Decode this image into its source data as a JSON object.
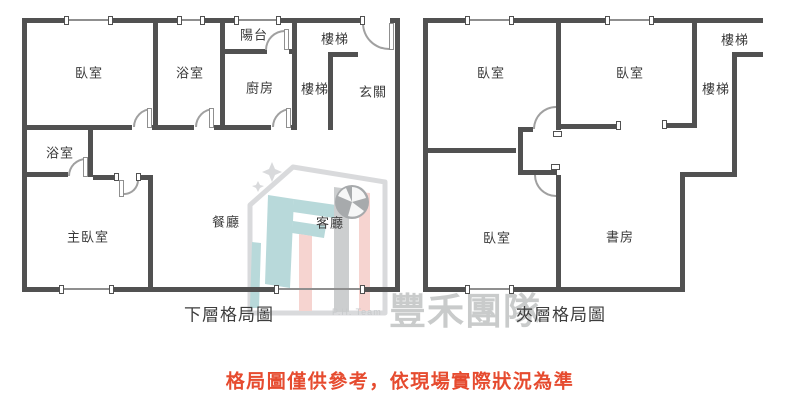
{
  "plans": {
    "lower": {
      "caption": "下層格局圖",
      "rooms": {
        "bedroom": "臥室",
        "bath1": "浴室",
        "balcony": "陽台",
        "kitchen": "廚房",
        "stairs1": "樓梯",
        "stairs2": "樓梯",
        "entry": "玄關",
        "bath2": "浴室",
        "master": "主臥室",
        "dining": "餐廳",
        "living": "客廳"
      }
    },
    "mezzanine": {
      "caption": "夾層格局圖",
      "rooms": {
        "bedroom1": "臥室",
        "bedroom2": "臥室",
        "stairs1": "樓梯",
        "stairs2": "樓梯",
        "bedroom3": "臥室",
        "study": "書房"
      }
    }
  },
  "watermark": {
    "team_name": "豐禾團隊",
    "team_sub": "P.H. Team"
  },
  "disclaimer": "格局圖僅供參考，依現場實際狀況為準",
  "colors": {
    "wall": "#515151",
    "disclaimer_red": "#e64b2f",
    "watermark_gray": "#c9cbcb",
    "logo_teal": "#b8d9da",
    "logo_pink": "#f6d4d0"
  }
}
